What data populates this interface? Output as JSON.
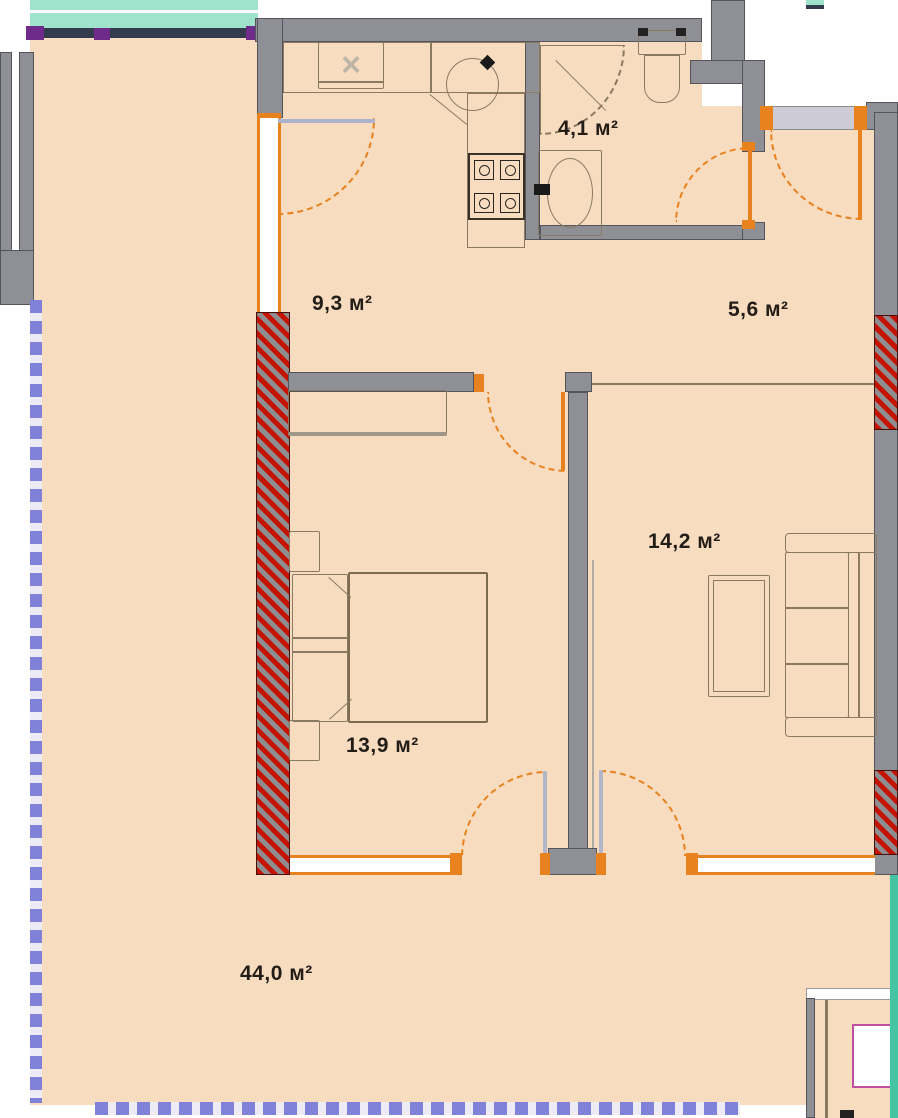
{
  "plan": {
    "unit": "м²",
    "rooms": [
      {
        "id": "bathroom",
        "area": "4,1 м²"
      },
      {
        "id": "kitchen-hall",
        "area": "9,3 м²"
      },
      {
        "id": "corridor",
        "area": "5,6 м²"
      },
      {
        "id": "living-room",
        "area": "14,2 м²"
      },
      {
        "id": "bedroom",
        "area": "13,9 м²"
      },
      {
        "id": "terrace",
        "area": "44,0 м²"
      }
    ],
    "icons": {
      "washing_machine_mark": "×"
    },
    "colors": {
      "floor": "#f8dcc0",
      "wall": "#8f9095",
      "wall_dark": "#54555c",
      "accent": "#e8821e",
      "pillar": "#c41400",
      "railing": "#7f82d8",
      "balcony_glass": "#9fe3cc",
      "furniture": "#8a7a62",
      "neighbor_door": "#c050a0",
      "label_text": "#221d17"
    }
  }
}
